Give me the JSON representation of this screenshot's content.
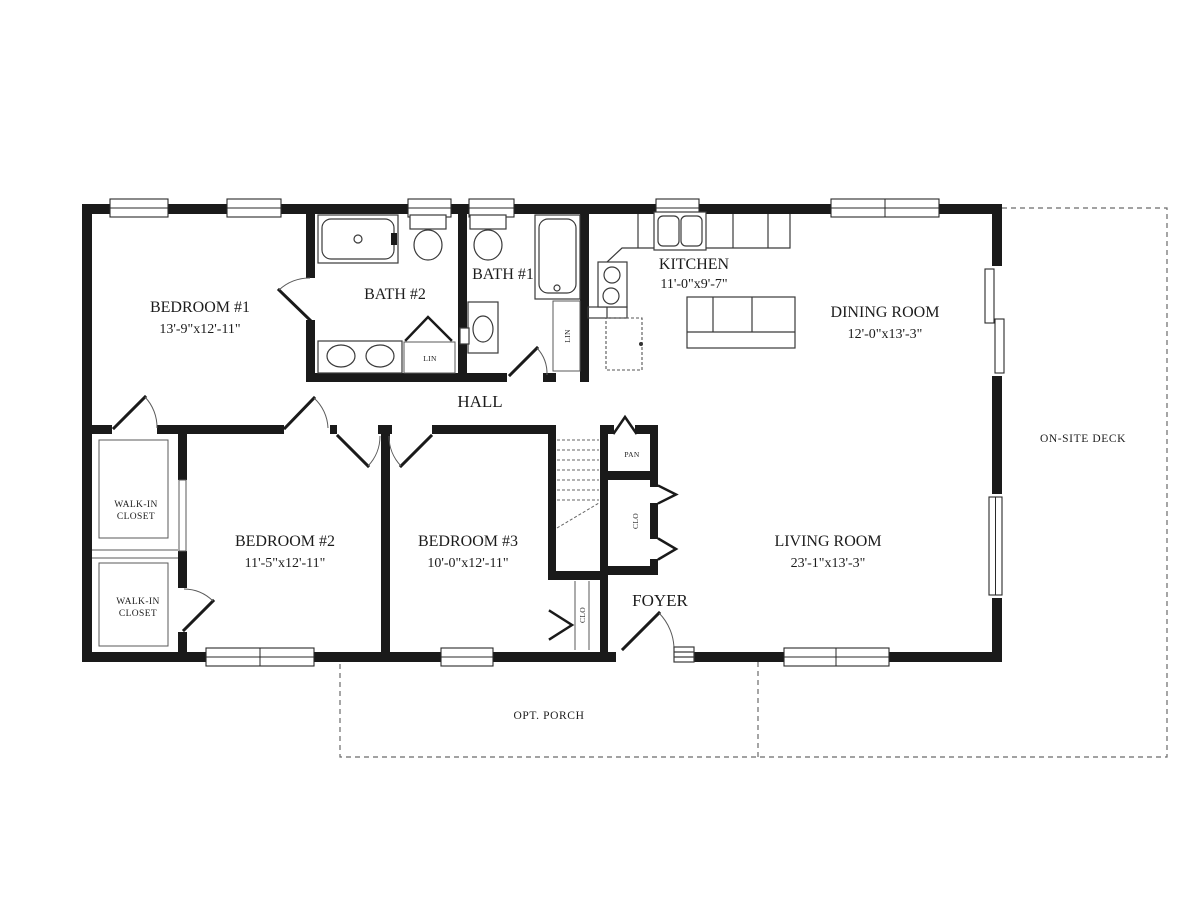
{
  "floorplan": {
    "rooms": {
      "bedroom1": {
        "name": "BEDROOM #1",
        "dims": "13'-9\"x12'-11\""
      },
      "bath2": {
        "name": "BATH #2"
      },
      "bath1": {
        "name": "BATH #1"
      },
      "kitchen": {
        "name": "KITCHEN",
        "dims": "11'-0\"x9'-7\""
      },
      "dining": {
        "name": "DINING ROOM",
        "dims": "12'-0\"x13'-3\""
      },
      "hall": {
        "name": "HALL"
      },
      "bedroom2": {
        "name": "BEDROOM #2",
        "dims": "11'-5\"x12'-11\""
      },
      "bedroom3": {
        "name": "BEDROOM #3",
        "dims": "10'-0\"x12'-11\""
      },
      "living": {
        "name": "LIVING ROOM",
        "dims": "23'-1\"x13'-3\""
      },
      "foyer": {
        "name": "FOYER"
      }
    },
    "closets": {
      "walkin1_line1": "WALK-IN",
      "walkin1_line2": "CLOSET",
      "walkin2_line1": "WALK-IN",
      "walkin2_line2": "CLOSET",
      "lin_bath2": "LIN",
      "lin_bath1": "LIN",
      "pantry": "PAN",
      "clo_hall": "CLO",
      "clo_foyer": "CLO"
    },
    "outdoor": {
      "deck": "ON-SITE DECK",
      "porch": "OPT. PORCH"
    },
    "colors": {
      "wall": "#1a1a1a",
      "thin_line": "#5a5a5a",
      "dashed_line": "#6a6a6a",
      "background": "#ffffff"
    }
  }
}
